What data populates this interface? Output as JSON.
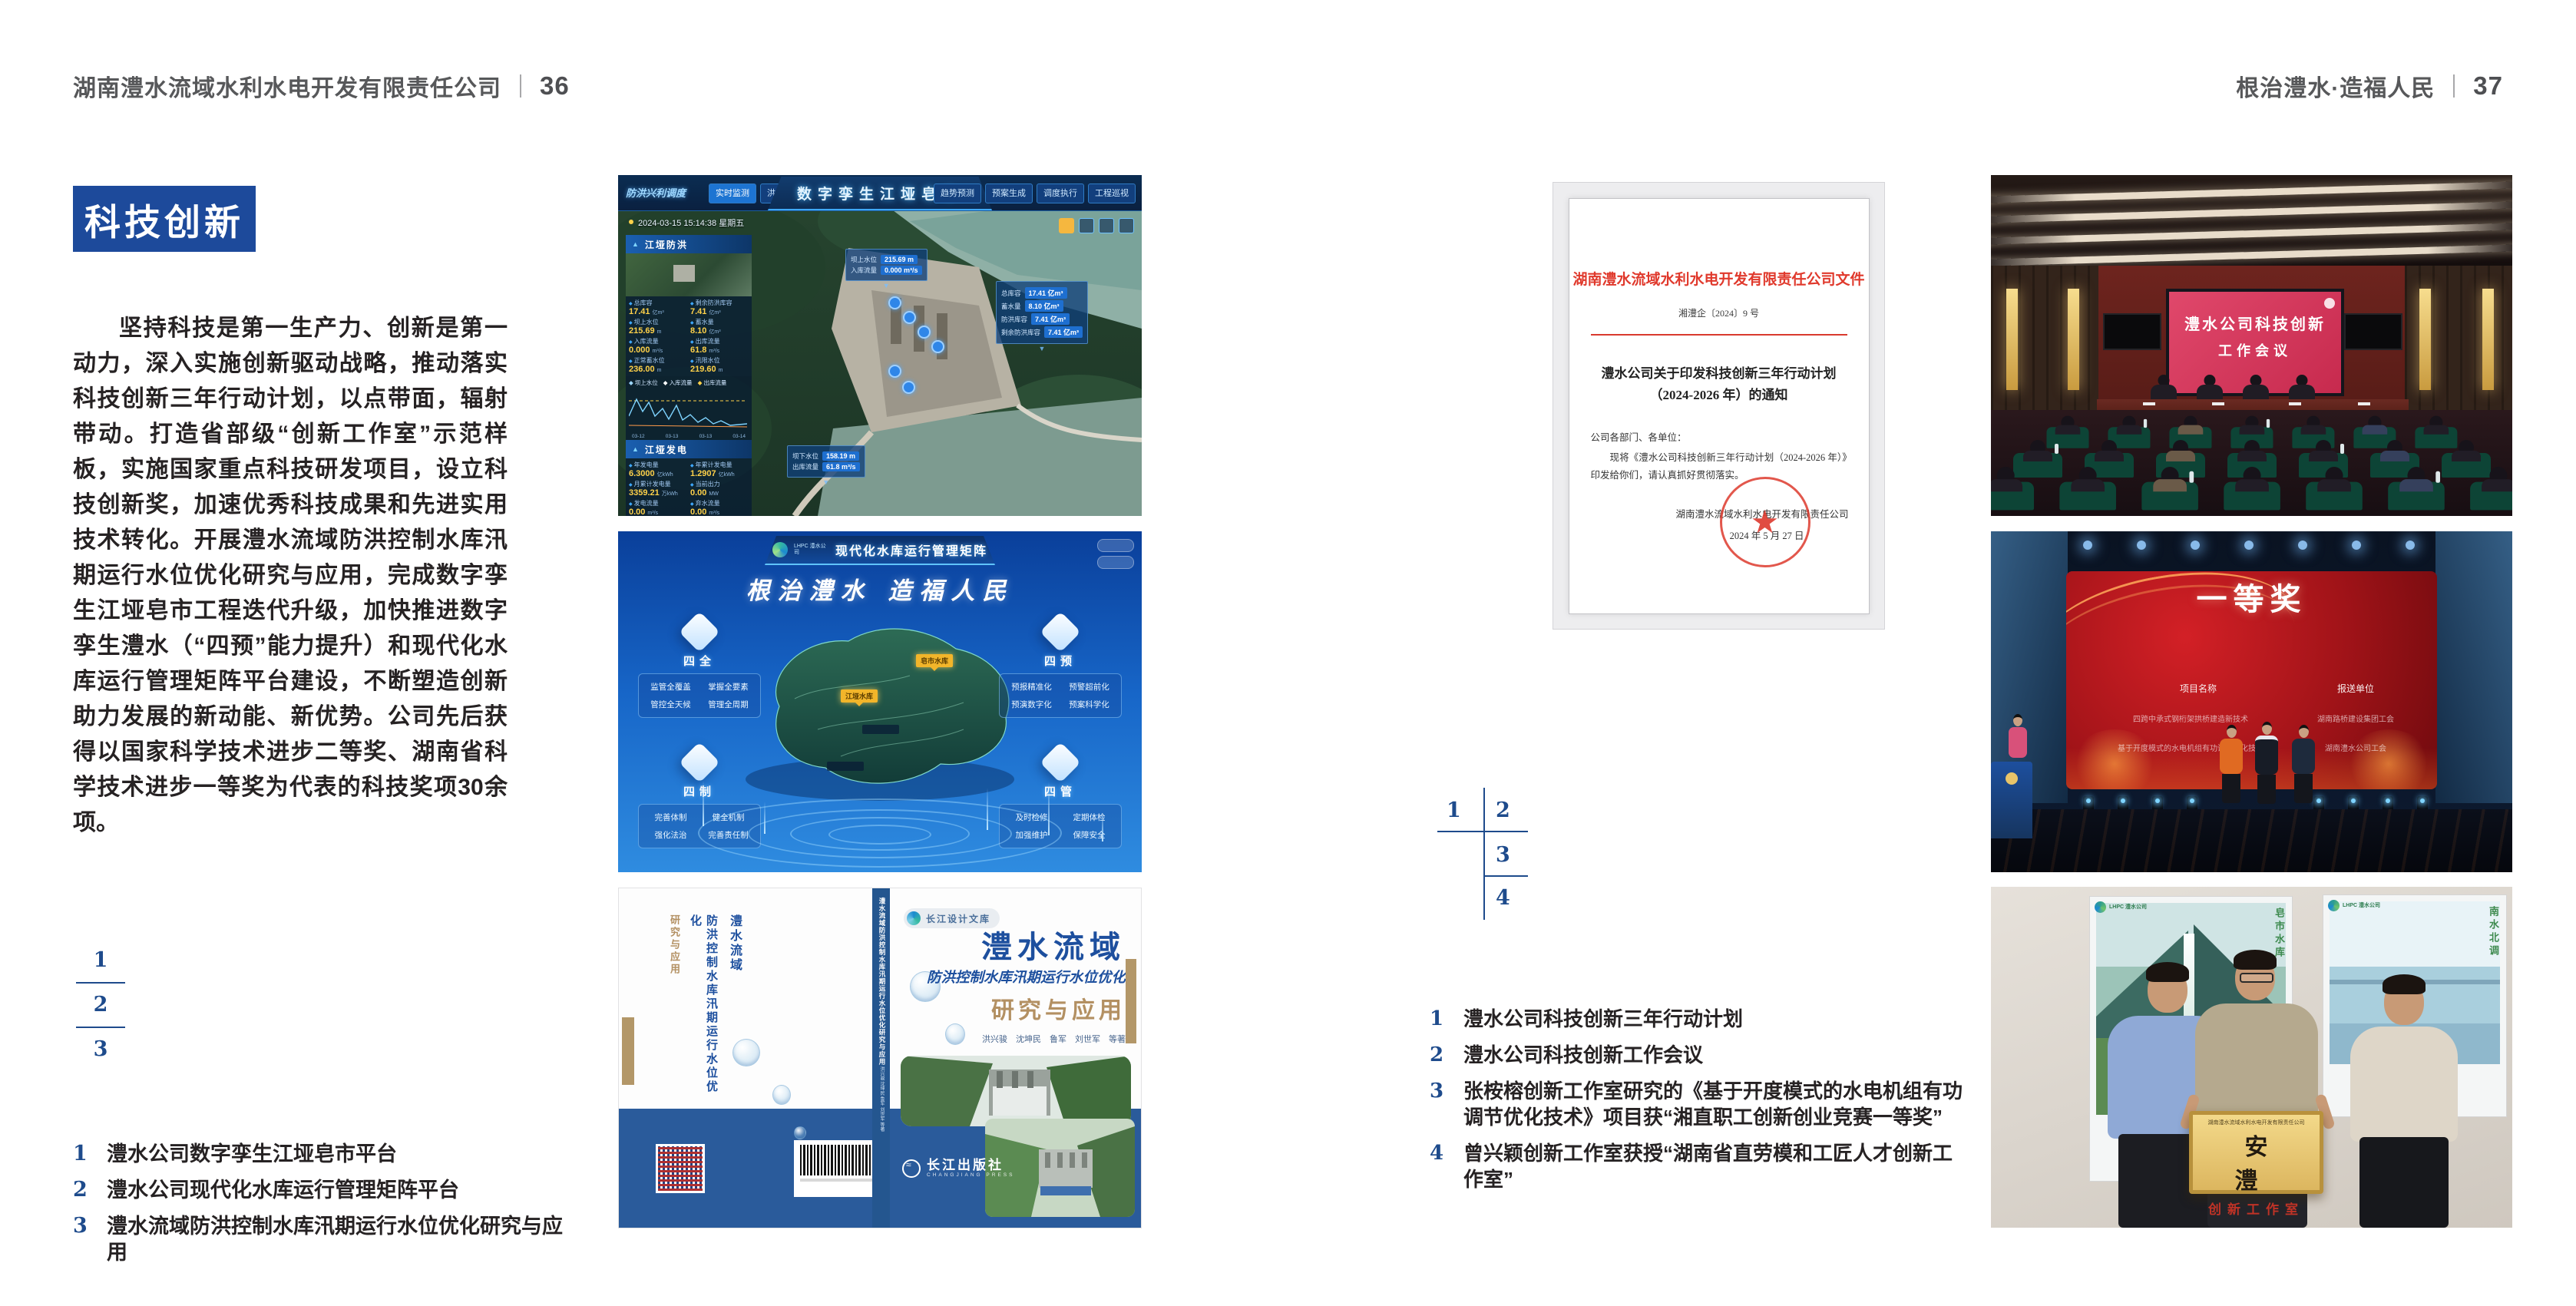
{
  "colors": {
    "accent_blue": "#1d4a9b",
    "index_blue": "#1e4b8c",
    "doc_red": "#d93a2e",
    "tan": "#b39768",
    "band_blue": "#2a5b9b",
    "meeting_screen": "#d8406a",
    "award_red": "#b01318"
  },
  "header": {
    "left_company": "湖南澧水流域水利水电开发有限责任公司",
    "left_page": "36",
    "right_slogan": "根治澧水·造福人民",
    "right_page": "37"
  },
  "left_page": {
    "section_title": "科技创新",
    "body": "坚持科技是第一生产力、创新是第一动力，深入实施创新驱动战略，推动落实科技创新三年行动计划，以点带面，辐射带动。打造省部级“创新工作室”示范样板，实施国家重点科技研发项目，设立科技创新奖，加速优秀科技成果和先进实用技术转化。开展澧水流域防洪控制水库汛期运行水位优化研究与应用，完成数字孪生江垭皂市工程迭代升级，加快推进数字孪生澧水（“四预”能力提升）和现代化水库运行管理矩阵平台建设，不断塑造创新助力发展的新动能、新优势。公司先后获得以国家科学技术进步二等奖、湖南省科学技术进步一等奖为代表的科技奖项30余项。",
    "index": [
      "1",
      "2",
      "3"
    ],
    "captions": [
      {
        "num": "1",
        "text": "澧水公司数字孪生江垭皂市平台"
      },
      {
        "num": "2",
        "text": "澧水公司现代化水库运行管理矩阵平台"
      },
      {
        "num": "3",
        "text": "澧水流域防洪控制水库汛期运行水位优化研究与应用"
      }
    ]
  },
  "fig_twin": {
    "title": "数字孪生江垭皂市",
    "module_label": "防洪兴利调度",
    "tabs_left": [
      "实时监测",
      "洪水预报",
      "防洪预警"
    ],
    "tabs_right": [
      "趋势预测",
      "预案生成",
      "调度执行",
      "工程巡视"
    ],
    "timestamp": "2024-03-15 15:14:38 星期五",
    "panel_flood": {
      "title": "江垭防洪",
      "stats": [
        {
          "label": "总库容",
          "value": "17.41",
          "unit": "亿m³"
        },
        {
          "label": "剩余防洪库容",
          "value": "7.41",
          "unit": "亿m³"
        },
        {
          "label": "坝上水位",
          "value": "215.69",
          "unit": "m"
        },
        {
          "label": "蓄水量",
          "value": "8.10",
          "unit": "亿m³"
        },
        {
          "label": "入库流量",
          "value": "0.000",
          "unit": "m³/s"
        },
        {
          "label": "出库流量",
          "value": "61.8",
          "unit": "m³/s"
        },
        {
          "label": "正常蓄水位",
          "value": "236.00",
          "unit": "m"
        },
        {
          "label": "汛限水位",
          "value": "219.60",
          "unit": "m"
        }
      ]
    },
    "chart": {
      "legend": [
        "坝上水位",
        "入库流量",
        "出库流量"
      ],
      "x_labels": [
        "03-12",
        "03-13",
        "03-13",
        "03-14"
      ]
    },
    "panel_power": {
      "title": "江垭发电",
      "stats": [
        {
          "label": "年发电量",
          "value": "6.3000",
          "unit": "亿kWh"
        },
        {
          "label": "年累计发电量",
          "value": "1.2907",
          "unit": "亿kWh"
        },
        {
          "label": "月累计发电量",
          "value": "3359.21",
          "unit": "万kWh"
        },
        {
          "label": "当前出力",
          "value": "0.00",
          "unit": "MW"
        },
        {
          "label": "发电流量",
          "value": "0.00",
          "unit": "m³/s"
        },
        {
          "label": "弃水流量",
          "value": "0.00",
          "unit": "m³/s"
        }
      ]
    },
    "tooltip_up": {
      "rows": [
        {
          "label": "坝上水位",
          "value": "215.69 m"
        },
        {
          "label": "入库流量",
          "value": "0.000 m³/s"
        }
      ]
    },
    "tooltip_cap": {
      "rows": [
        {
          "label": "总库容",
          "value": "17.41 亿m³"
        },
        {
          "label": "蓄水量",
          "value": "8.10 亿m³"
        },
        {
          "label": "防洪库容",
          "value": "7.41 亿m³"
        },
        {
          "label": "剩余防洪库容",
          "value": "7.41 亿m³"
        }
      ]
    },
    "tooltip_down": {
      "rows": [
        {
          "label": "坝下水位",
          "value": "158.19 m"
        },
        {
          "label": "出库流量",
          "value": "61.8 m³/s"
        }
      ]
    }
  },
  "fig_matrix": {
    "brand_small": "LHPC 澧水公司",
    "title": "现代化水库运行管理矩阵",
    "slogan": "根治澧水 造福人民",
    "marker_jiangya": "江垭水库",
    "marker_zaoshi": "皂市水库",
    "groups": [
      {
        "title": "四全",
        "items": [
          "监管全覆盖",
          "掌握全要素",
          "管控全天候",
          "管理全周期"
        ]
      },
      {
        "title": "四预",
        "items": [
          "预报精准化",
          "预警超前化",
          "预演数字化",
          "预案科学化"
        ]
      },
      {
        "title": "四制",
        "items": [
          "完善体制",
          "健全机制",
          "强化法治",
          "完善责任制"
        ]
      },
      {
        "title": "四管",
        "items": [
          "及时检修",
          "定期体检",
          "加强维护",
          "保障安全"
        ]
      }
    ]
  },
  "fig_book": {
    "series_badge": "长江设计文库",
    "title_main": "澧水流域",
    "title_sub": "防洪控制水库汛期运行水位优化",
    "title_tail": "研究与应用",
    "authors": "洪兴骏　沈坤民　鲁军　刘世军　等著",
    "spine_title": "澧水流域防洪控制水库汛期运行水位优化研究与应用",
    "spine_authors": "洪兴骏 沈坤民 鲁军 刘世军 等著",
    "publisher": "长江出版社",
    "publisher_en": "CHANGJIANG PRESS",
    "back_title_1": "澧水流域",
    "back_title_2": "防洪控制水库汛期运行水位优化",
    "back_title_3": "研究与应用"
  },
  "right_page": {
    "document": {
      "header": "湖南澧水流域水利水电开发有限责任公司文件",
      "doc_no": "湘澧企〔2024〕9 号",
      "title_line1": "澧水公司关于印发科技创新三年行动计划",
      "title_line2": "（2024-2026 年）的通知",
      "salutation": "公司各部门、各单位：",
      "body": "现将《澧水公司科技创新三年行动计划（2024-2026 年）》印发给你们，请认真抓好贯彻落实。",
      "sign_org": "湖南澧水流域水利水电开发有限责任公司",
      "sign_date": "2024 年 5 月 27 日",
      "seal_star": "★"
    },
    "index": [
      "1",
      "2",
      "3",
      "4"
    ],
    "captions": [
      {
        "num": "1",
        "text": "澧水公司科技创新三年行动计划"
      },
      {
        "num": "2",
        "text": "澧水公司科技创新工作会议"
      },
      {
        "num": "3",
        "text": "张桉榕创新工作室研究的《基于开度模式的水电机组有功调节优化技术》项目获“湘直职工创新创业竞赛一等奖”"
      },
      {
        "num": "4",
        "text": "曾兴颖创新工作室获授“湖南省直劳模和工匠人才创新工作室”"
      }
    ]
  },
  "photo_meeting": {
    "screen_line1": "澧水公司科技创新",
    "screen_line2": "工作会议"
  },
  "photo_award": {
    "screen_title": "一等奖",
    "col1_header": "项目名称",
    "col2_header": "报送单位",
    "col1_rows": [
      "四跨中承式钢桁架拱桥建造新技术",
      "基于开度模式的水电机组有功调节优化技术"
    ],
    "col2_rows": [
      "湖南路桥建设集团工会",
      "湖南澧水公司工会"
    ]
  },
  "photo_group": {
    "plaque_org": "湖南澧水流域水利水电开发有限责任公司",
    "plaque_title": "安　澧",
    "plaque_sub": "创新工作室",
    "poster_brand": "LHPC 澧水公司",
    "poster_left_caption": "皂市水库",
    "poster_right_caption": "南水北调"
  }
}
